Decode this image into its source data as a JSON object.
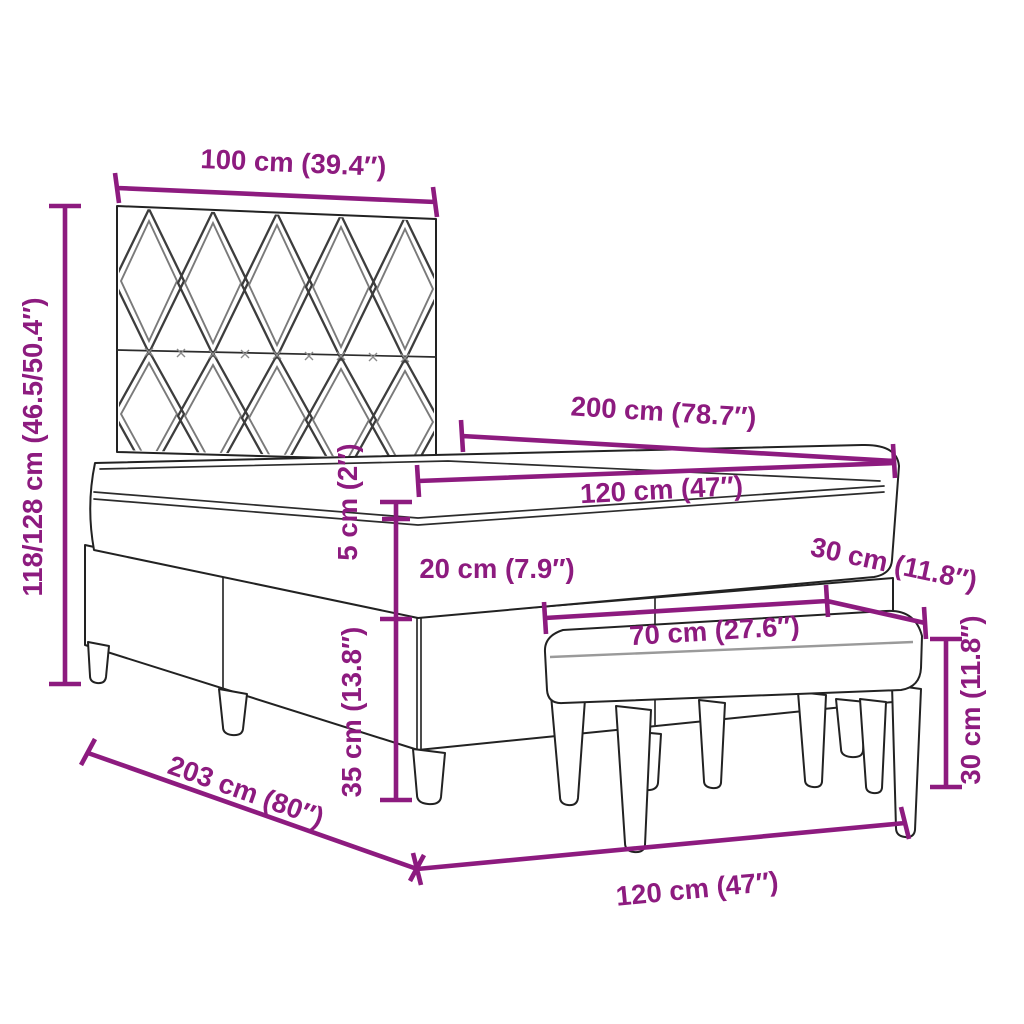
{
  "diagram": {
    "title": "bed-with-bench-dimension-diagram",
    "colors": {
      "dimension": "#8D1B7F",
      "outline": "#222222",
      "pattern_line": "#3d3d3d",
      "background": "#ffffff"
    },
    "dimensions": {
      "headboard_width": "100 cm (39.4″)",
      "bed_height_range": "118/128 cm (46.5/50.4″)",
      "bed_length": "200 cm (78.7″)",
      "bed_width": "120 cm (47″)",
      "topper_height": "5 cm (2″)",
      "mattress_height": "20 cm (7.9″)",
      "bench_depth": "30 cm (11.8″)",
      "bench_length": "70 cm (27.6″)",
      "base_height": "35 cm (13.8″)",
      "bench_height": "30 cm (11.8″)",
      "bed_total_length": "203 cm (80″)",
      "bed_width_floor": "120 cm (47″)"
    }
  }
}
